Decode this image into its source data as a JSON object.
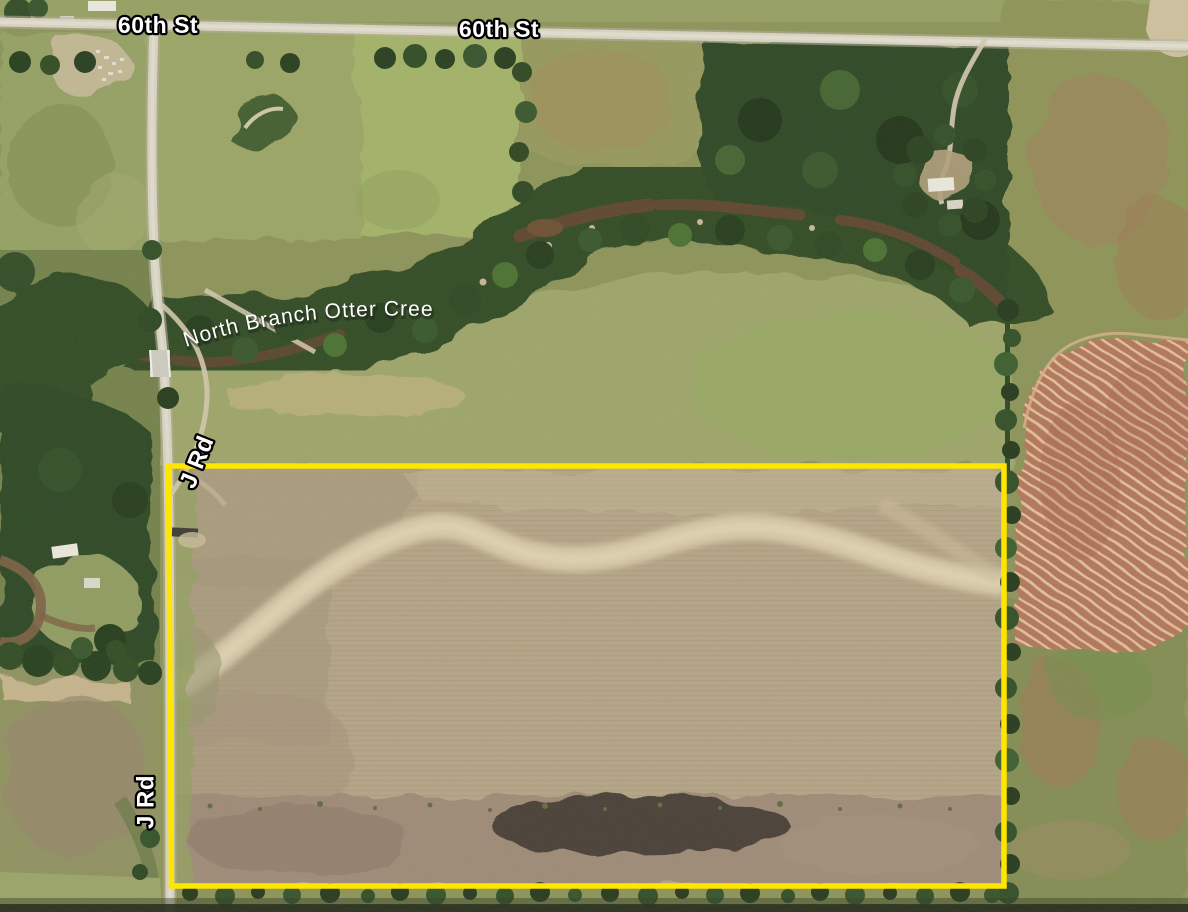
{
  "map": {
    "type": "aerial-satellite-parcel-view",
    "labels": {
      "road_60th_west": "60th St",
      "road_60th_center": "60th St",
      "road_j_upper": "J Rd",
      "road_j_lower": "J Rd",
      "creek": "North Branch Otter Creek"
    },
    "boundary": {
      "color": "#ffe600",
      "shape": "rectangle",
      "represents": "outlined farmland parcel"
    },
    "palette": {
      "label_text": "#ffffff",
      "label_outline": "#000000",
      "plowed_field": "#b4a486",
      "meadow": "#9aa166",
      "forest": "#2c4520",
      "creek_water": "#5c442d",
      "road_surface": "#d9d4c4",
      "contour_field": "#b3755b",
      "contour_stripe": "#e3c097"
    }
  }
}
